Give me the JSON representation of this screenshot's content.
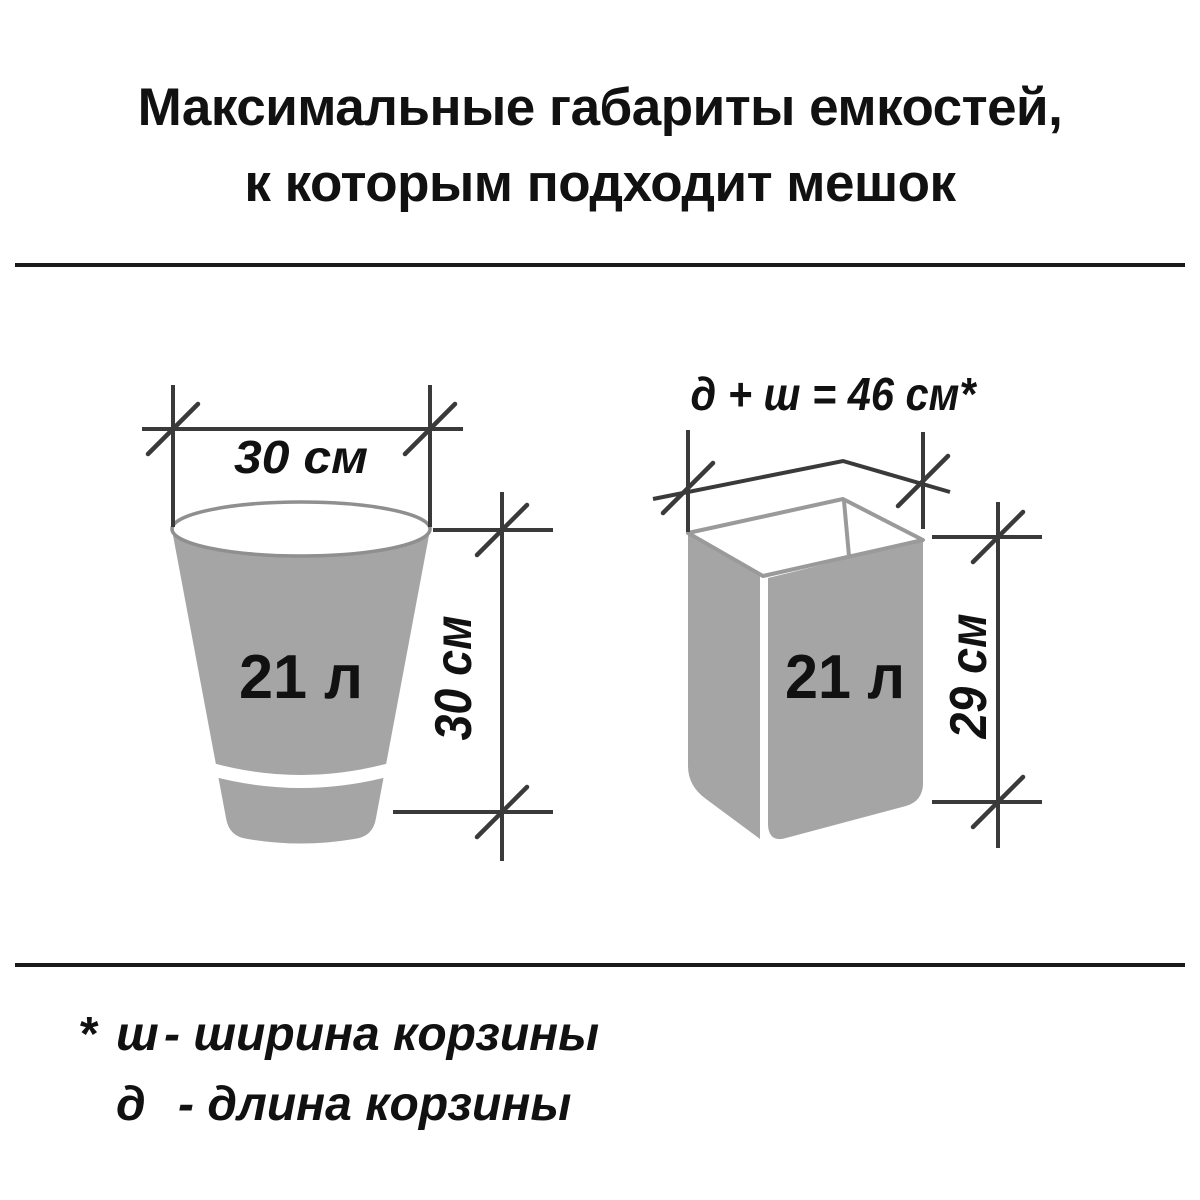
{
  "title": {
    "line1": "Максимальные габариты емкостей,",
    "line2": "к которым подходит мешок"
  },
  "bucket": {
    "volume_label": "21 л",
    "width_label": "30 см",
    "height_label": "30 см"
  },
  "basket": {
    "volume_label": "21 л",
    "dimension_formula_label": "д + ш = 46 см*",
    "height_label": "29 см"
  },
  "footnote": {
    "marker": "*",
    "lines": [
      {
        "symbol": "ш",
        "text": "- ширина корзины"
      },
      {
        "symbol": "д",
        "text": "- длина корзины"
      }
    ]
  },
  "colors": {
    "background": "#ffffff",
    "container_fill": "#a5a5a5",
    "container_outline": "#8f8f8f",
    "dimension_lines": "#3a3a3a",
    "separator": "#1a1a1a",
    "text": "#111111"
  }
}
